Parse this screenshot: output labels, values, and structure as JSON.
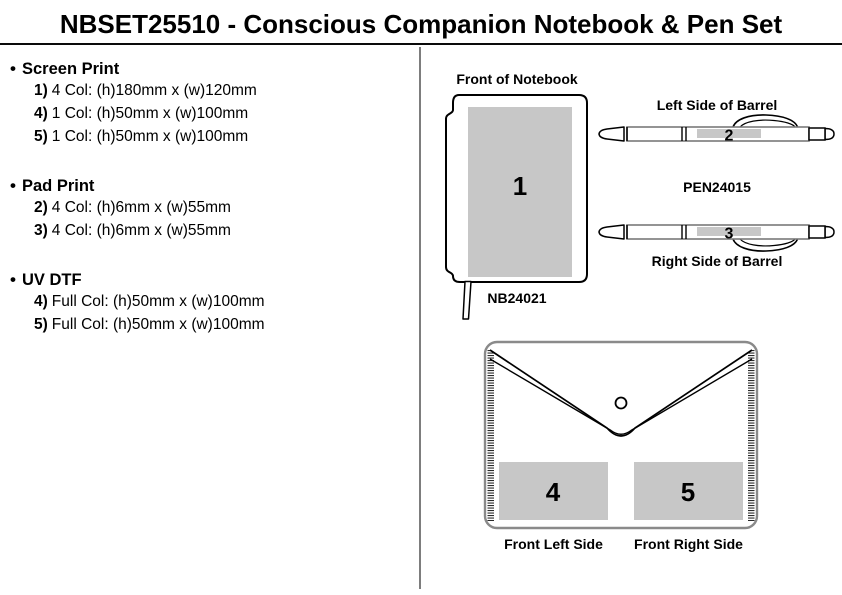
{
  "title": "NBSET25510 - Conscious Companion Notebook & Pen Set",
  "bullet": "•",
  "sections": [
    {
      "heading": "Screen Print",
      "items": [
        {
          "num": "1)",
          "text": "4 Col: (h)180mm x (w)120mm"
        },
        {
          "num": "4)",
          "text": "1 Col: (h)50mm x (w)100mm"
        },
        {
          "num": "5)",
          "text": "1 Col: (h)50mm x (w)100mm"
        }
      ]
    },
    {
      "heading": "Pad Print",
      "items": [
        {
          "num": "2)",
          "text": "4 Col: (h)6mm x (w)55mm"
        },
        {
          "num": "3)",
          "text": "4 Col: (h)6mm x (w)55mm"
        }
      ]
    },
    {
      "heading": "UV DTF",
      "items": [
        {
          "num": "4)",
          "text": "Full Col: (h)50mm x (w)100mm"
        },
        {
          "num": "5)",
          "text": "Full Col: (h)50mm x (w)100mm"
        }
      ]
    }
  ],
  "diagrams": {
    "notebook": {
      "label": "Front of Notebook",
      "code": "NB24021",
      "area_number": "1"
    },
    "pen": {
      "left_label": "Left Side of Barrel",
      "right_label": "Right Side of Barrel",
      "code": "PEN24015",
      "left_area_number": "2",
      "right_area_number": "3"
    },
    "pouch": {
      "left_label": "Front Left Side",
      "right_label": "Front Right Side",
      "left_area_number": "4",
      "right_area_number": "5"
    }
  },
  "colors": {
    "print_area": "#c7c7c7",
    "outline": "#000000",
    "pouch_outline": "#8a8a8a",
    "divider": "#7d7d7d"
  }
}
